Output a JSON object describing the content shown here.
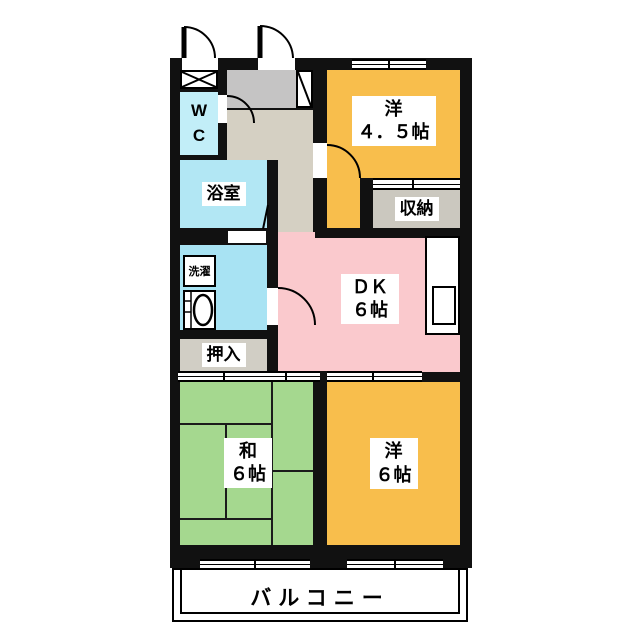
{
  "plan": {
    "wall_color": "#111111",
    "rooms": {
      "western45": {
        "line1": "洋",
        "line2": "４．５帖",
        "color": "#F8BE4C"
      },
      "dk": {
        "line1": "ＤＫ",
        "line2": "６帖",
        "color": "#FAC9CD"
      },
      "japanese6": {
        "line1": "和",
        "line2": "６帖",
        "color": "#A5D88F"
      },
      "western6": {
        "line1": "洋",
        "line2": "６帖",
        "color": "#F8BE4C"
      },
      "wc": {
        "line1": "W",
        "line2": "C",
        "color": "#C2EEF8"
      },
      "bath": {
        "label": "浴室",
        "color": "#B2E7F4"
      },
      "washroom": {
        "laundry_label": "洗濯",
        "color": "#A8E3F3"
      },
      "oshiire": {
        "label": "押入",
        "color": "#D1CEC5"
      },
      "storage": {
        "label": "収納",
        "color": "#CBC8BF"
      },
      "genkan": {
        "color": "#C5C4C4"
      },
      "hallway": {
        "color": "#D5D0C3"
      },
      "balcony": {
        "label": "バルコニー"
      }
    }
  }
}
